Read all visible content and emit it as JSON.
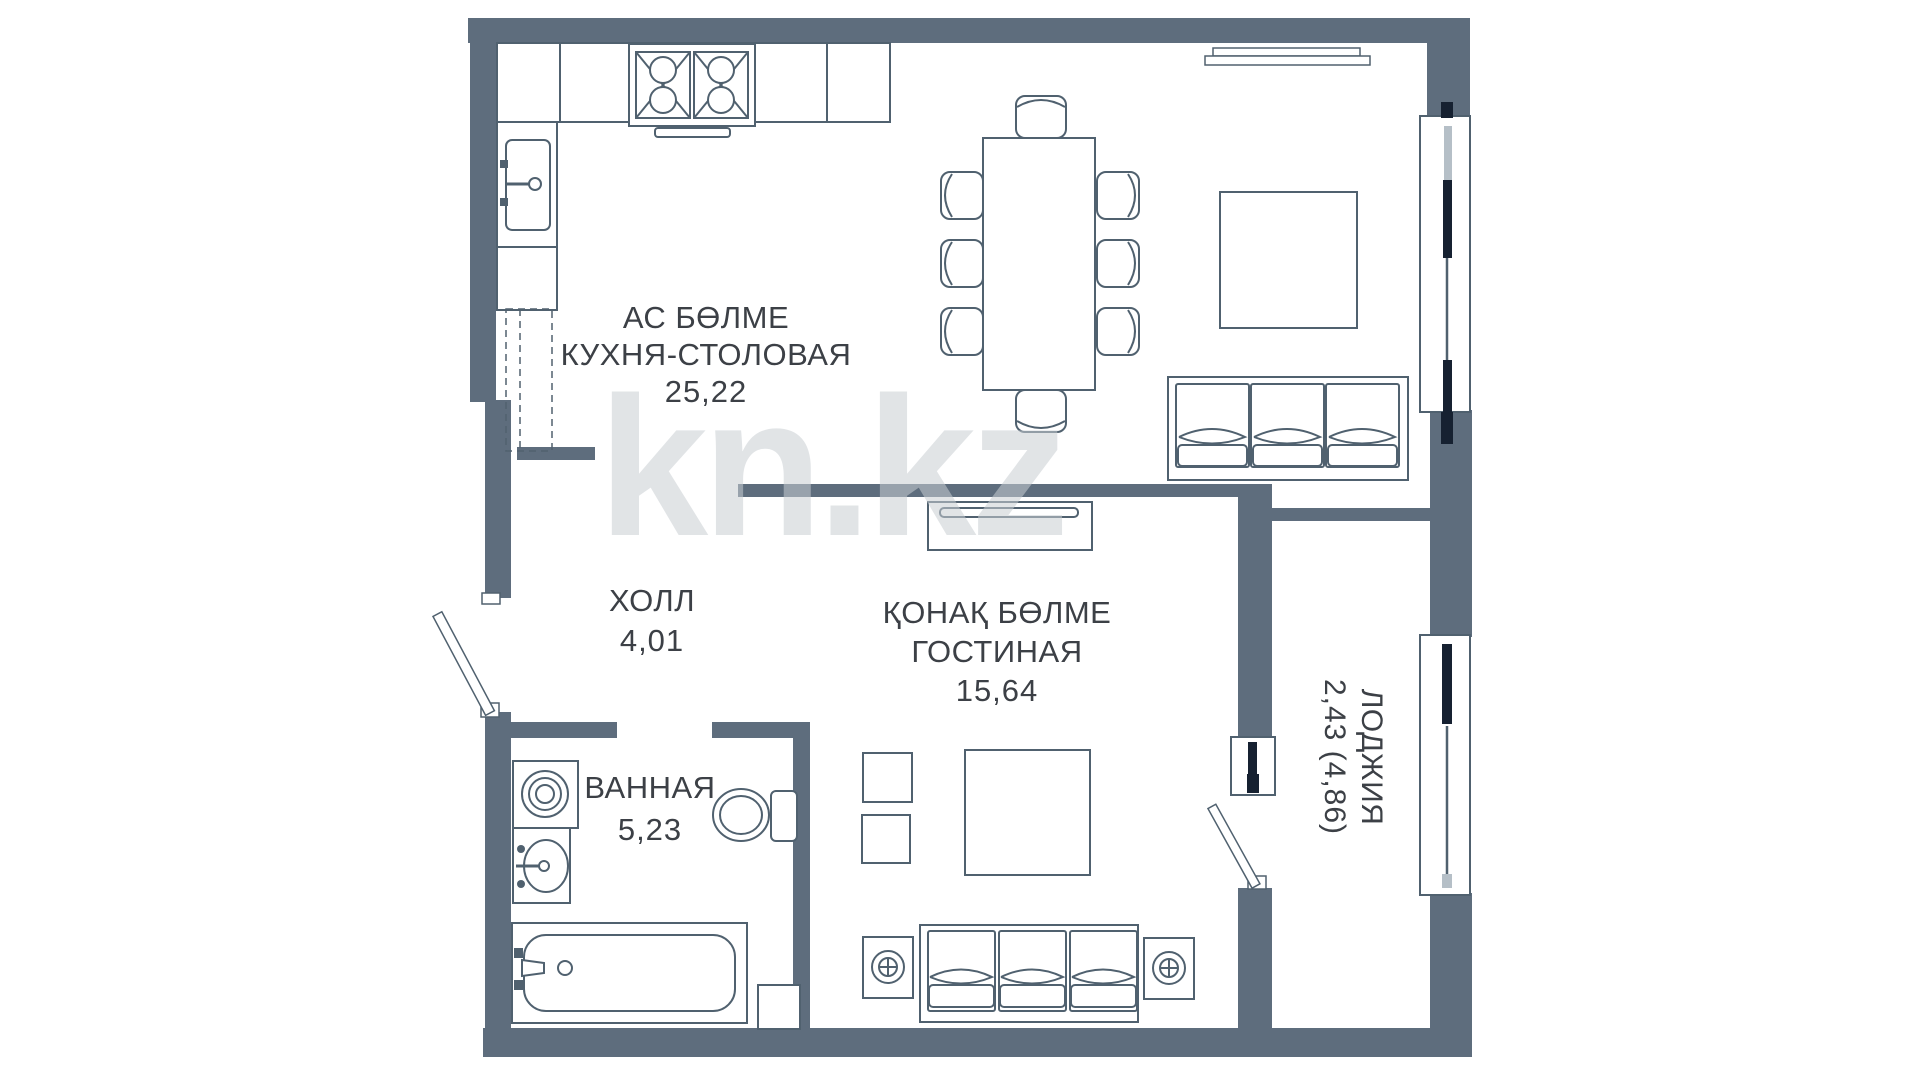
{
  "watermark": "kn.kz",
  "plan": {
    "rooms": [
      {
        "name_kk": "АС БӨЛМЕ",
        "name_ru": "КУХНЯ-СТОЛОВАЯ",
        "area": "25,22"
      },
      {
        "name_kk": "",
        "name_ru": "ХОЛЛ",
        "area": "4,01"
      },
      {
        "name_kk": "ҚОНАҚ БӨЛМЕ",
        "name_ru": "ГОСТИНАЯ",
        "area": "15,64"
      },
      {
        "name_kk": "",
        "name_ru": "ВАННАЯ",
        "area": "5,23"
      },
      {
        "name_kk": "",
        "name_ru": "ЛОДЖИЯ",
        "area": "2,43 (4,86)"
      }
    ],
    "icons": {
      "freezer": "✻ ✻ ✻"
    },
    "colors": {
      "wall": "#5e6d7d",
      "line": "#50616f",
      "sash_dark": "#162131",
      "sash_light": "#b5bfc7",
      "text": "#3c4046",
      "watermark": "#c9ced3"
    }
  }
}
